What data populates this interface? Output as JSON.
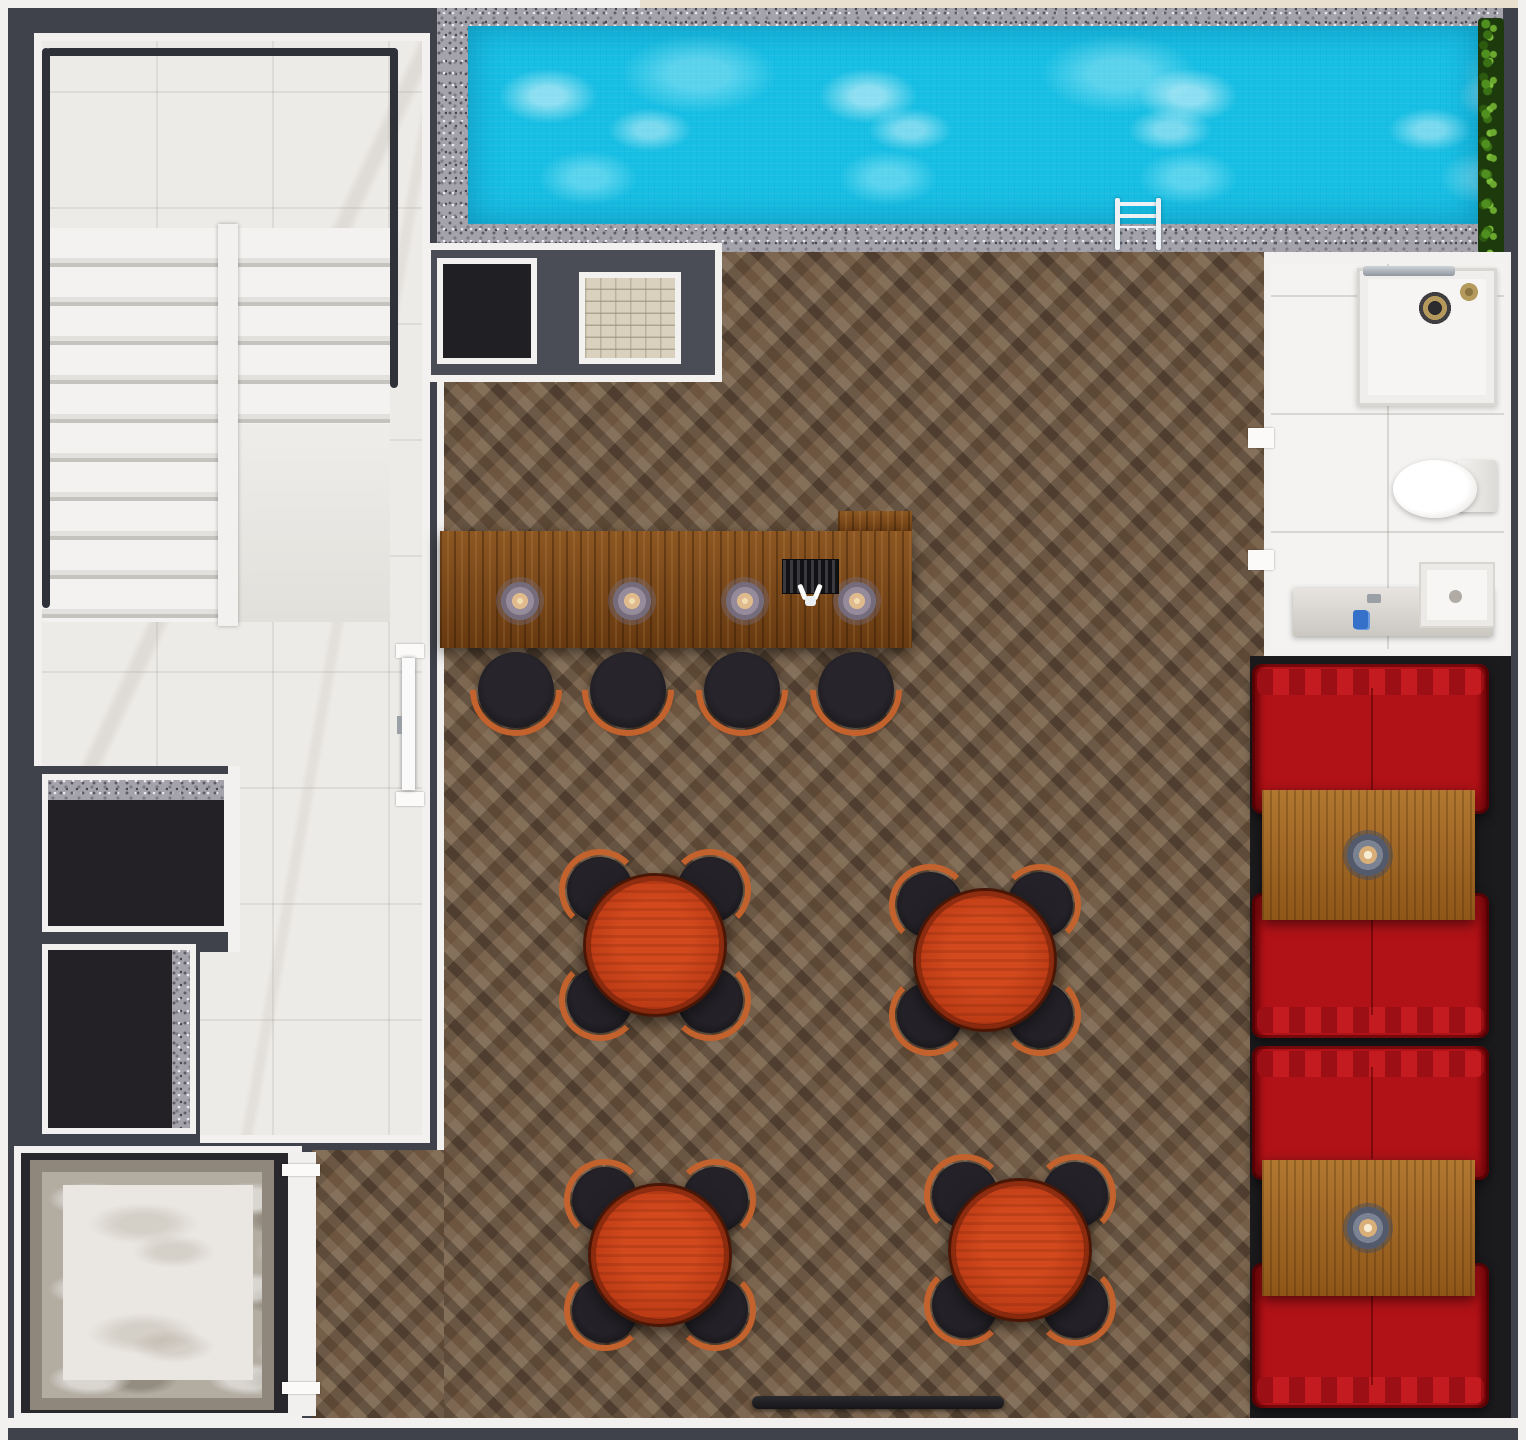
{
  "scene": {
    "type": "architectural-floor-plan-render",
    "view": "top-down",
    "description": "Photoreal 3D top-down floor plan of a bar lounge level with lap pool, marble stairwell, storage rooms, elevator shaft, bathroom and red booth seating. No text labels are rendered in the image."
  },
  "rooms": [
    {
      "id": "stairwell",
      "label": "Marble staircase hall",
      "floor": "white marble tile",
      "features": [
        "U-shaped staircase with two flights",
        "black metal handrail",
        "two dark storage rooms with granite thresholds",
        "door to bar lounge"
      ]
    },
    {
      "id": "pool-terrace",
      "label": "Lap pool",
      "floor": "grey granite deck",
      "features": [
        "turquoise mosaic water",
        "chrome pool ladder",
        "green hedge along right end",
        "beige coping strip at top"
      ]
    },
    {
      "id": "bar-lounge",
      "label": "Bar lounge",
      "floor": "herringbone oak parquet",
      "features": [
        "L-shaped wooden bar counter",
        "four bar stools",
        "four round dining tables",
        "black entry mat"
      ]
    },
    {
      "id": "wall-niche",
      "label": "Service niche",
      "features": [
        "black panel",
        "beige brick panel"
      ]
    },
    {
      "id": "bathroom",
      "label": "Bathroom",
      "floor": "white ceramic tile",
      "features": [
        "shower tray with chrome bar and shower head",
        "wall-hung toilet",
        "marble vanity with sink",
        "two door openings"
      ]
    },
    {
      "id": "booth-area",
      "label": "Booth seating alcove",
      "floor": "dark slate",
      "features": [
        "two facing red booth sets",
        "rectangular oak tables",
        "center candle lamps"
      ]
    },
    {
      "id": "elevator-room",
      "label": "Elevator shaft",
      "features": [
        "grey and white marble platform",
        "white access corridor"
      ]
    }
  ],
  "furniture": {
    "bar_counter": {
      "label": "L-shaped wooden bar counter",
      "place_settings": 4,
      "beer_tap_station": 1
    },
    "bar_stools": {
      "count": 4,
      "color": "black",
      "accent": "copper crescent back"
    },
    "dining_sets": {
      "count": 4,
      "table_shape": "round",
      "table_finish": "red-orange wood",
      "chairs_per_table": 4,
      "chair_color": "black with copper trim"
    },
    "booths": {
      "count": 2,
      "sofas_per_booth": 2,
      "sofa_color": "crimson red",
      "table_finish": "honey oak",
      "candle_lamps": 2
    },
    "bathroom_fixtures": {
      "shower": 1,
      "toilet": 1,
      "vanity_sink": 1
    },
    "pool_ladder": {
      "count": 1,
      "finish": "chrome"
    },
    "storage_rooms": {
      "count": 2,
      "floor": "dark slate",
      "threshold": "granite"
    },
    "entry_mat": {
      "count": 1,
      "color": "black"
    }
  },
  "colors": {
    "wall_charcoal": "#3f424a",
    "wall_white": "#f2f1ef",
    "pool_water": "#18bfe4",
    "granite_grey": "#a4a3ab",
    "parquet_brown": "#6f5c49",
    "bar_wood": "#7c4716",
    "booth_table_wood": "#a4661f",
    "sofa_red": "#b01217",
    "table_red": "#bb3a14",
    "chair_black": "#18161b",
    "chair_accent": "#c4622d",
    "marble_white": "#edebe8",
    "room_dark": "#232126",
    "brick_beige": "#d9d1bd",
    "hedge_green": "#4f8f1f",
    "tile_white": "#f4f3f1",
    "trim_beige": "#e9e0d0",
    "niche_grey": "#4a4d55",
    "booth_floor_dark": "#1b1a1d"
  }
}
